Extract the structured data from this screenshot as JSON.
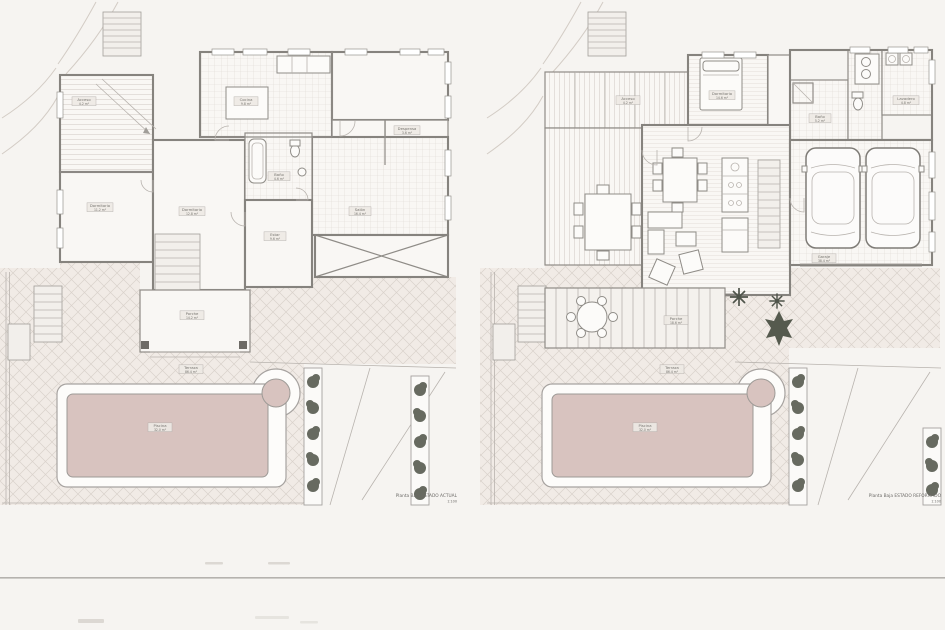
{
  "sheet": {
    "type": "architectural floor plan drawing, two plans side by side",
    "divider_color": "#a9a6a2"
  },
  "colors": {
    "paper": "#f6f4f1",
    "terrace_hatch_base": "#f1ebe6",
    "pool_water": "#d8c3bf",
    "wall": "#86837e",
    "shrub": "#5c6055",
    "thin_line": "#b8b3ae"
  },
  "plans": [
    {
      "caption": {
        "line1": "Planta Baja ESTADO ACTUAL",
        "line2": "1:100"
      },
      "labels": {
        "acceso": {
          "name": "Acceso",
          "area": "4.2 m²"
        },
        "cocina": {
          "name": "Cocina",
          "area": "9.8 m²"
        },
        "despensa": {
          "name": "Despensa",
          "area": "3.6 m²"
        },
        "dormitorio1": {
          "name": "Dormitorio",
          "area": "11.2 m²"
        },
        "dormitorio2": {
          "name": "Dormitorio",
          "area": "12.8 m²"
        },
        "bano": {
          "name": "Baño",
          "area": "4.6 m²"
        },
        "estar": {
          "name": "Estar",
          "area": "9.6 m²"
        },
        "salon": {
          "name": "Salón",
          "area": "16.4 m²"
        },
        "porche": {
          "name": "Porche",
          "area": "14.2 m²"
        },
        "terraza": {
          "name": "Terraza",
          "area": "86.4 m²"
        },
        "piscina": {
          "name": "Piscina",
          "area": "32.0 m²"
        }
      }
    },
    {
      "caption": {
        "line1": "Planta Baja ESTADO REFORMADO",
        "line2": "1:100"
      },
      "labels": {
        "acceso": {
          "name": "Acceso",
          "area": "4.2 m²"
        },
        "dormitorio": {
          "name": "Dormitorio",
          "area": "14.6 m²"
        },
        "bano": {
          "name": "Baño",
          "area": "5.2 m²"
        },
        "lavadero": {
          "name": "Lavadero",
          "area": "4.8 m²"
        },
        "garaje": {
          "name": "Garaje",
          "area": "38.4 m²"
        },
        "porche": {
          "name": "Porche",
          "area": "18.6 m²"
        },
        "terraza": {
          "name": "Terraza",
          "area": "86.4 m²"
        },
        "piscina": {
          "name": "Piscina",
          "area": "32.0 m²"
        }
      }
    }
  ]
}
